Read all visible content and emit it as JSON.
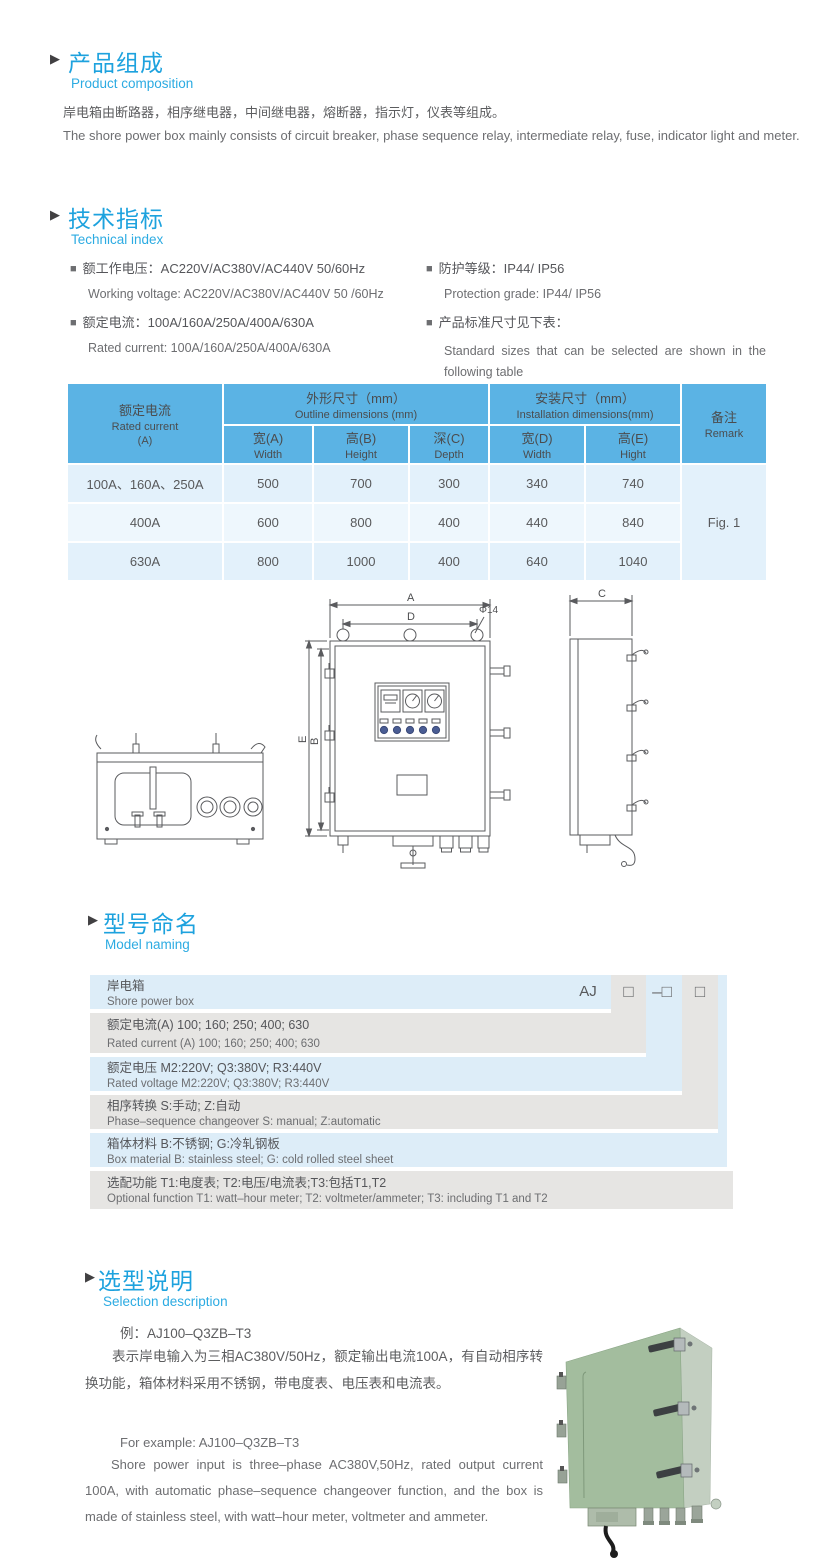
{
  "colors": {
    "accent_blue": "#29abe2",
    "table_header_blue": "#5bb3e4",
    "table_row_light": "#e3f1fb",
    "table_row_lighter": "#eef7fd",
    "band_blue": "#ddedf8",
    "band_gray": "#e6e5e3",
    "text_gray": "#58595b",
    "photo_green": "#a3bd9e"
  },
  "product": {
    "title_cn": "产品组成",
    "title_en": "Product composition",
    "body_cn": "岸电箱由断路器，相序继电器，中间继电器，熔断器，指示灯，仪表等组成。",
    "body_en": "The shore power box mainly consists of circuit breaker, phase sequence relay, intermediate relay, fuse, indicator light and meter."
  },
  "technical": {
    "title_cn": "技术指标",
    "title_en": "Technical index",
    "items": [
      {
        "cn": "额工作电压：AC220V/AC380V/AC440V  50/60Hz",
        "en": "Working voltage: AC220V/AC380V/AC440V 50 /60Hz"
      },
      {
        "cn": "额定电流：100A/160A/250A/400A/630A",
        "en": "Rated current: 100A/160A/250A/400A/630A"
      },
      {
        "cn": "防护等级：IP44/ IP56",
        "en": "Protection grade: IP44/ IP56"
      },
      {
        "cn": "产品标准尺寸见下表：",
        "en": "Standard sizes that can be selected are shown in the following table"
      }
    ],
    "bullet": "■"
  },
  "table": {
    "header": {
      "rated_cn": "额定电流",
      "rated_en": "Rated current",
      "rated_unit": "(A)",
      "outline_cn": "外形尺寸（mm）",
      "outline_en": "Outline dimensions (mm)",
      "install_cn": "安装尺寸（mm）",
      "install_en": "Installation dimensions(mm)",
      "remark_cn": "备注",
      "remark_en": "Remark",
      "cols": [
        {
          "cn": "宽(A)",
          "en": "Width"
        },
        {
          "cn": "高(B)",
          "en": "Height"
        },
        {
          "cn": "深(C)",
          "en": "Depth"
        },
        {
          "cn": "宽(D)",
          "en": "Width"
        },
        {
          "cn": "高(E)",
          "en": "Hight"
        }
      ]
    },
    "rows": [
      {
        "current": "100A、160A、250A",
        "a": "500",
        "b": "700",
        "c": "300",
        "d": "340",
        "e": "740"
      },
      {
        "current": "400A",
        "a": "600",
        "b": "800",
        "c": "400",
        "d": "440",
        "e": "840"
      },
      {
        "current": "630A",
        "a": "800",
        "b": "1000",
        "c": "400",
        "d": "640",
        "e": "1040"
      }
    ],
    "remark_value": "Fig. 1"
  },
  "drawing": {
    "labels": {
      "a": "A",
      "d": "D",
      "phi": "Φ14",
      "e": "E",
      "b": "B",
      "c": "C"
    }
  },
  "model": {
    "title_cn": "型号命名",
    "title_en": "Model naming",
    "header_cn": "岸电箱",
    "header_en": "Shore power box",
    "prefix": "AJ",
    "slot1": "□",
    "slot2": "–□",
    "slot3": "□",
    "rows": [
      {
        "cn": "额定电流(A)  100; 160; 250; 400; 630",
        "en": "Rated current (A) 100; 160; 250; 400; 630"
      },
      {
        "cn": "额定电压   M2:220V;  Q3:380V;  R3:440V",
        "en": "Rated voltage   M2:220V;  Q3:380V;  R3:440V"
      },
      {
        "cn": "相序转换  S:手动; Z:自动",
        "en": "Phase–sequence changeover  S: manual;  Z:automatic"
      },
      {
        "cn": "箱体材料    B:不锈钢;  G:冷轧钢板",
        "en": "Box material    B: stainless steel; G: cold rolled steel sheet"
      },
      {
        "cn": "选配功能     T1:电度表;  T2:电压/电流表;T3:包括T1,T2",
        "en": "Optional function  T1: watt–hour meter; T2: voltmeter/ammeter; T3: including T1 and T2"
      }
    ]
  },
  "selection": {
    "title_cn": "选型说明",
    "title_en": "Selection description",
    "example_cn": "例：AJ100–Q3ZB–T3",
    "body_cn": "表示岸电输入为三相AC380V/50Hz，额定输出电流100A，有自动相序转换功能，箱体材料采用不锈钢，带电度表、电压表和电流表。",
    "example_en": "For example: AJ100–Q3ZB–T3",
    "body_en": "Shore power input is three–phase AC380V,50Hz, rated output current 100A, with automatic phase–sequence changeover function, and the box is made of stainless steel, with watt–hour meter, voltmeter and ammeter."
  }
}
